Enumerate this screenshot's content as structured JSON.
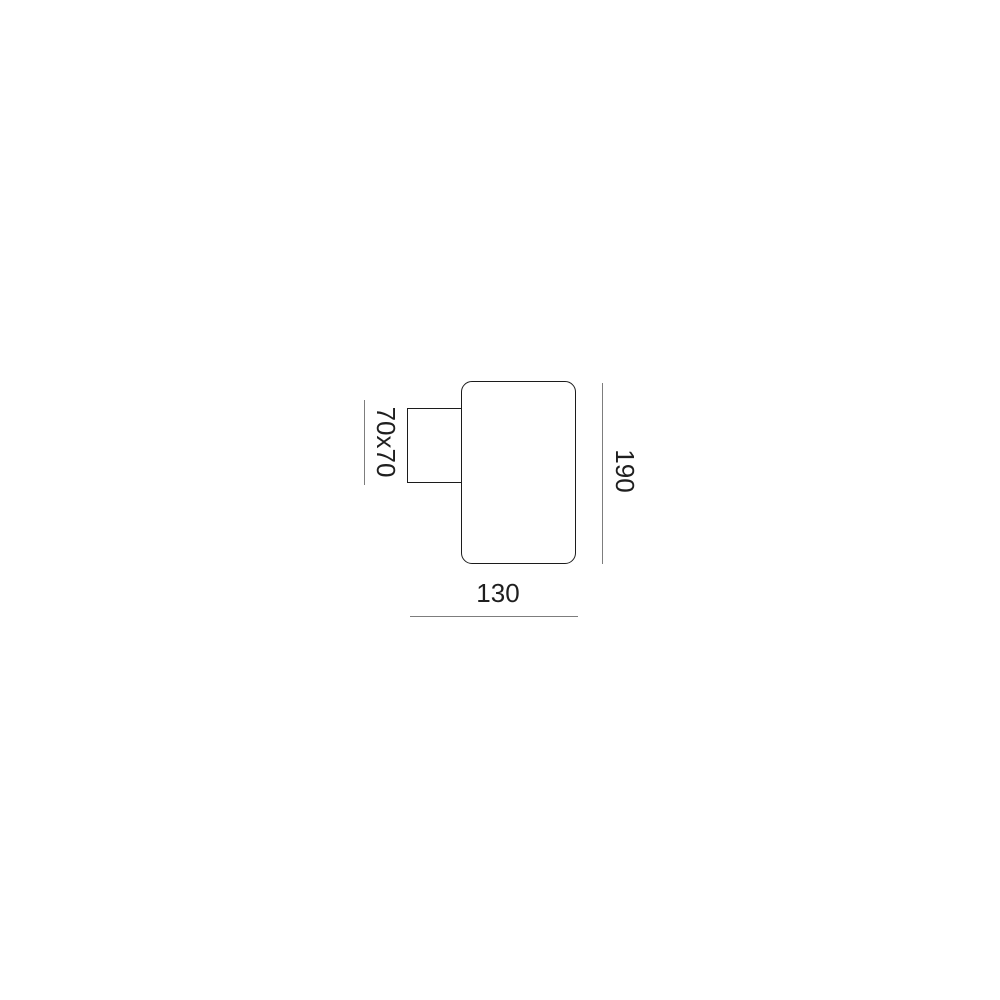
{
  "diagram": {
    "type": "technical-dimension-drawing",
    "subject": "wall-light-fixture-side-view",
    "background_color": "#ffffff",
    "outline_color": "#1c1c1c",
    "dimension_line_color": "#7d7d7d",
    "label_color": "#1f1f1f",
    "shapes": {
      "body": "rounded-rectangle",
      "bracket": "rectangle"
    },
    "dimensions": {
      "bracket_label": "70x70",
      "height_label": "190",
      "width_label": "130"
    }
  }
}
